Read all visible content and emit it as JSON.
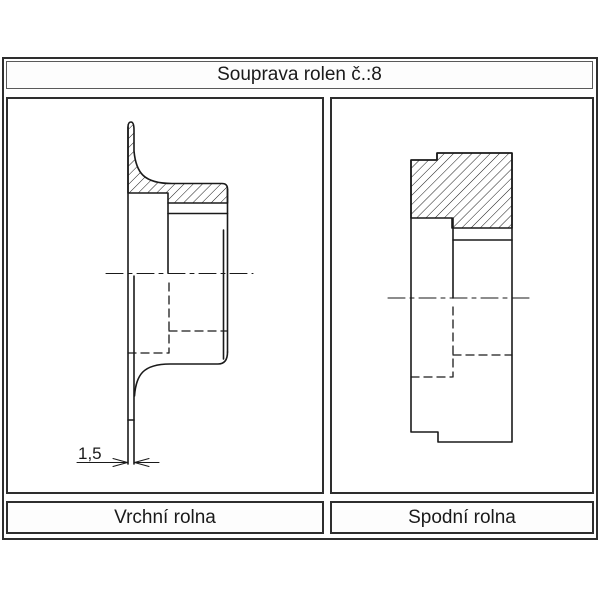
{
  "title": "Souprava rolen č.:8",
  "panels": [
    {
      "label": "Vrchní rolna"
    },
    {
      "label": "Spodní rolna"
    }
  ],
  "dimension": {
    "label": "1,5"
  },
  "colors": {
    "background": "#ffffff",
    "frame_border": "#2e2e2e",
    "line": "#1a1a1a"
  },
  "drawing": {
    "groups": [
      {
        "name": "top-roller-section",
        "hatch": [
          "M128,127 Q128,122 131,122 Q134,122 134,130 L134,151 C136,173 144,183.5 172,183.5 L222,183.5 Q227.5,183.5 227.5,189 L227.5,203 L168,203 L168,193 L128,193 Z"
        ],
        "solid": [
          "M128,127 L128,464",
          "M134,276 L134,464",
          "M227.5,189 L227.5,352",
          "M223.5,230 L223.5,359",
          "M168,203 L168,273",
          "M168,213.5 L227.5,213.5",
          "M134.5,396 C136,375 143,364 170,364 L218,364 Q227.5,364 227.5,352",
          "M128,420 L134,420"
        ],
        "hidden": [
          "M169,283 L169,353",
          "M169,331 L227,331",
          "M128,353 L169,353"
        ],
        "center": [
          "M106,273.5 L253,273.5"
        ],
        "thin": [
          "M77,462.5 L126.5,462.5",
          "M135.5,462.5 L159,462.5",
          "M127.5,462.5 L113,458.5 M127.5,462.5 L113,466.5",
          "M134.5,462.5 L149,458.5 M134.5,462.5 L149,466.5"
        ]
      },
      {
        "name": "bottom-roller-section",
        "hatch": [
          "M411,160 L437,160 L437,153 L512,153 L512,228 L452,228 L452,218 L411,218 Z"
        ],
        "solid": [
          "M411,160 L437,160 L437,153 L512,153 L512,442 L438,442 L438,432 L411,432 Z",
          "M453,240 L512,240",
          "M453,218 L453,298"
        ],
        "hidden": [
          "M453,307 L453,377",
          "M453,355 L512,355",
          "M411,377 L452,377"
        ],
        "center": [
          "M388,298 L533,298"
        ],
        "thin": []
      }
    ]
  }
}
